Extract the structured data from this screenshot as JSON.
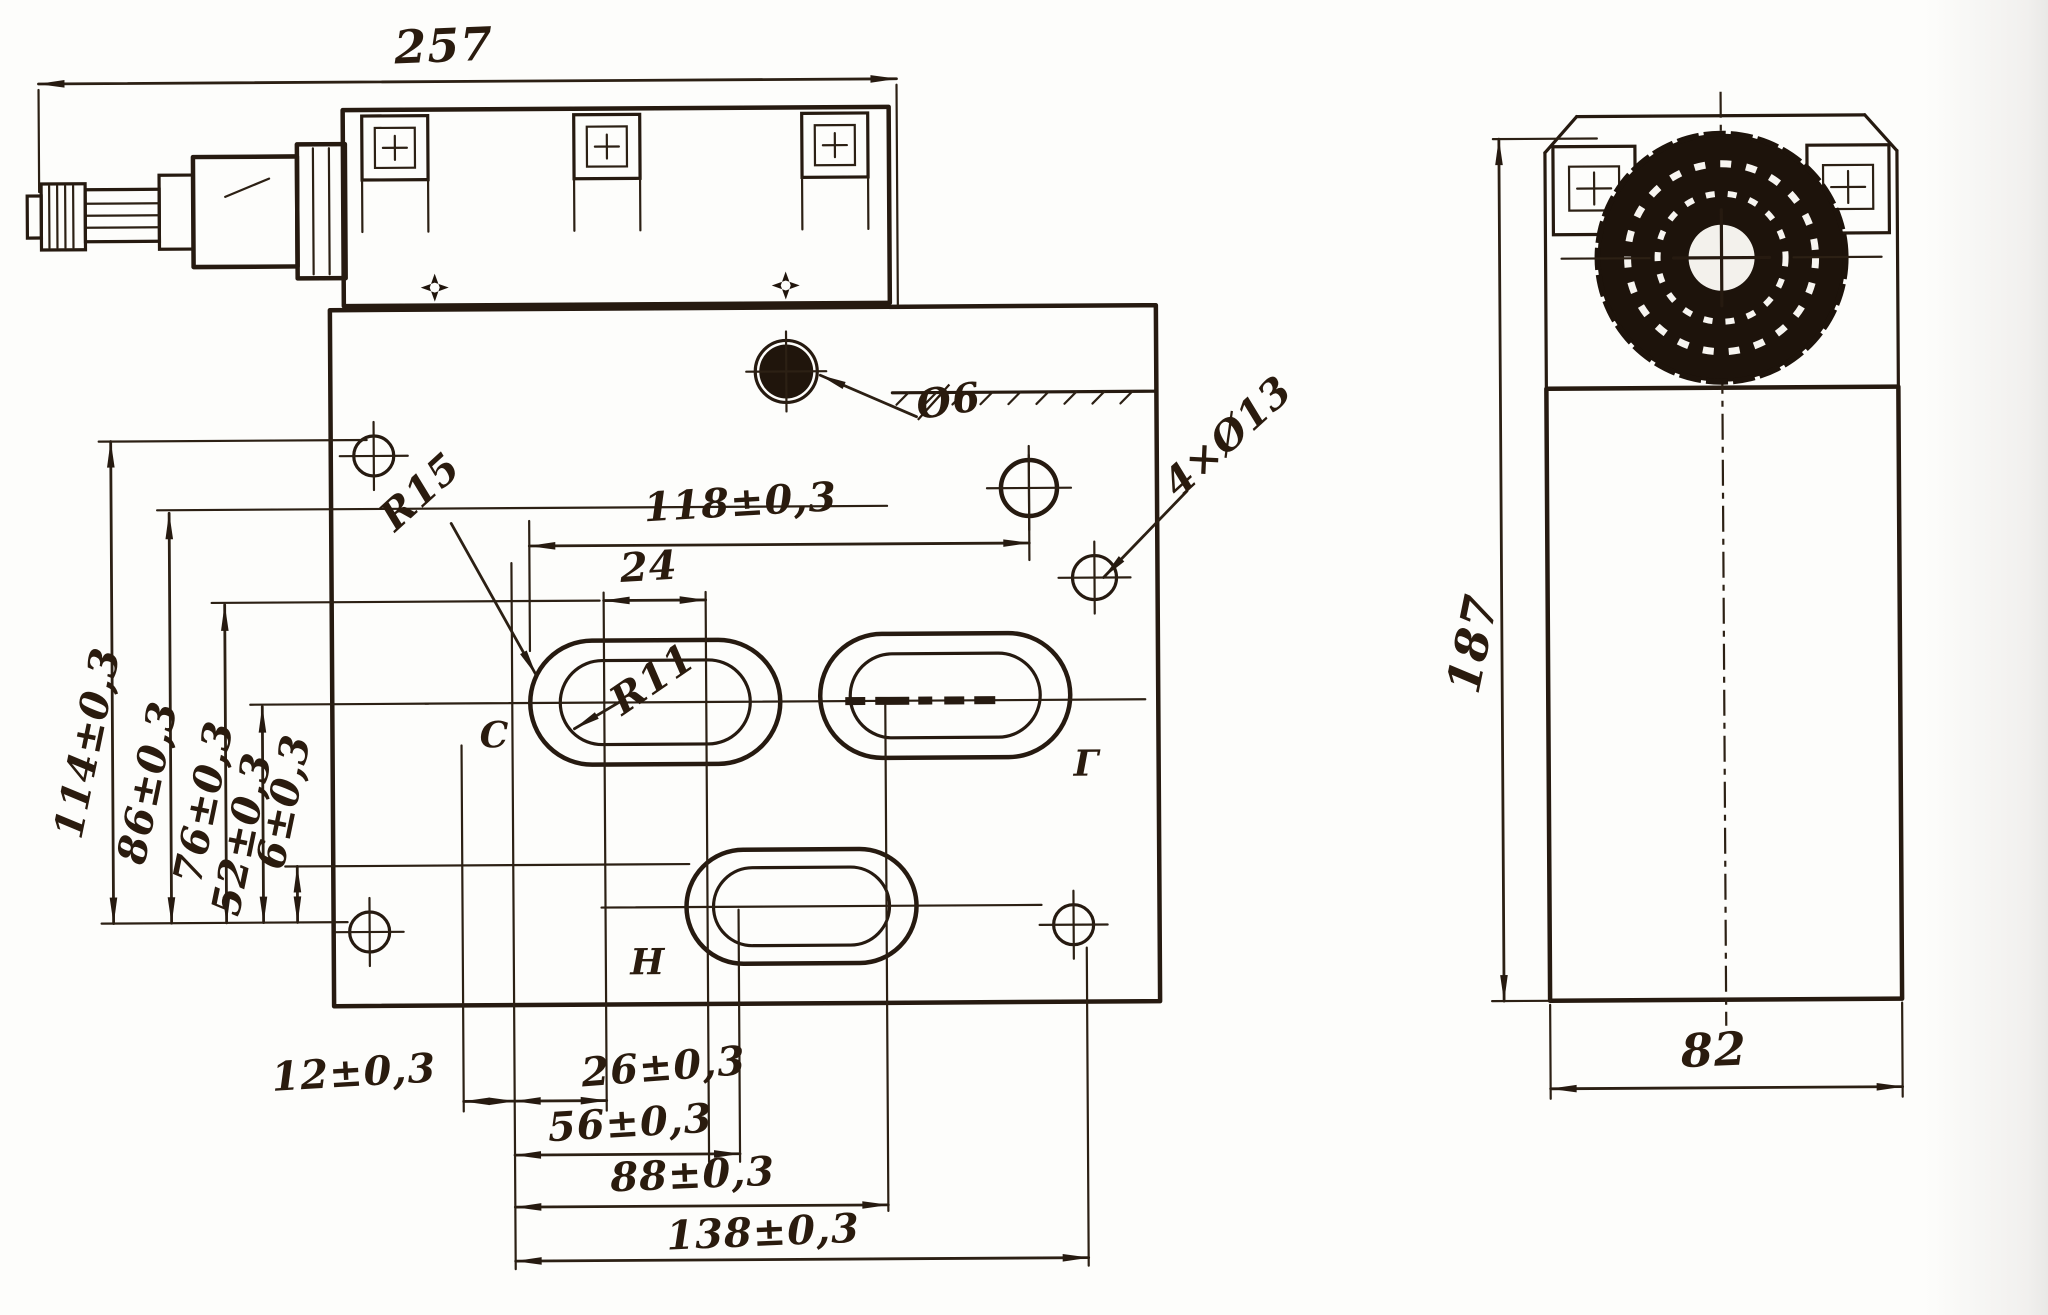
{
  "drawing": {
    "front": {
      "overall_width": "257",
      "v_dims": {
        "v114": "114±0,3",
        "v86": "86±0,3",
        "v76": "76±0,3",
        "v52": "52±0,3",
        "v6": "6±0,3"
      },
      "h_dim_top": "118±0,3",
      "slot_width": "24",
      "b_dims": {
        "b12": "12±0,3",
        "b26": "26±0,3",
        "b56": "56±0,3",
        "b88": "88±0,3",
        "b138": "138±0,3"
      },
      "radii": {
        "outer": "R15",
        "inner": "R11"
      },
      "holes": {
        "small": "Ø6",
        "corner": "4×Ø13"
      },
      "ports": {
        "c": "С",
        "g": "Г",
        "n": "Н"
      }
    },
    "side": {
      "height": "187",
      "width": "82"
    }
  }
}
